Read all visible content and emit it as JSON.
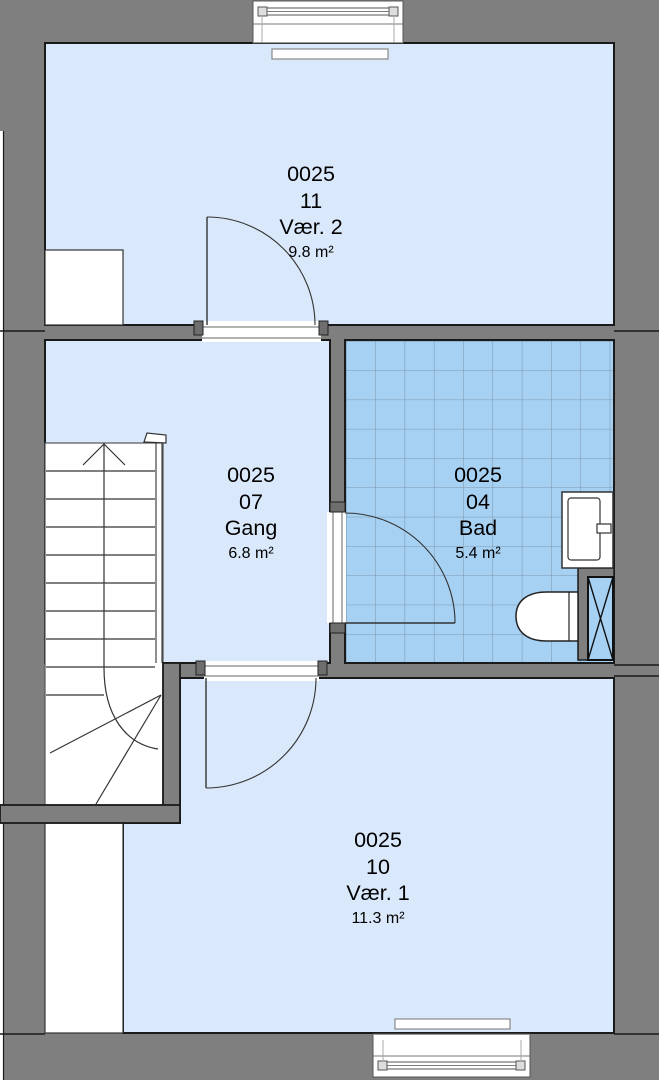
{
  "plan": {
    "rooms": [
      {
        "id": "vaer2",
        "code": "0025",
        "number": "11",
        "name": "Vær. 2",
        "area": "9.8 m²"
      },
      {
        "id": "gang",
        "code": "0025",
        "number": "07",
        "name": "Gang",
        "area": "6.8 m²"
      },
      {
        "id": "bad",
        "code": "0025",
        "number": "04",
        "name": "Bad",
        "area": "5.4 m²"
      },
      {
        "id": "vaer1",
        "code": "0025",
        "number": "10",
        "name": "Vær. 1",
        "area": "11.3 m²"
      }
    ],
    "colors": {
      "wall_gray": "#7f7f7f",
      "room_fill": "#d9e8fb",
      "tile_fill": "#a7d1f3",
      "tile_grid": "#7d97ac",
      "outline": "#1a1a1a"
    }
  }
}
